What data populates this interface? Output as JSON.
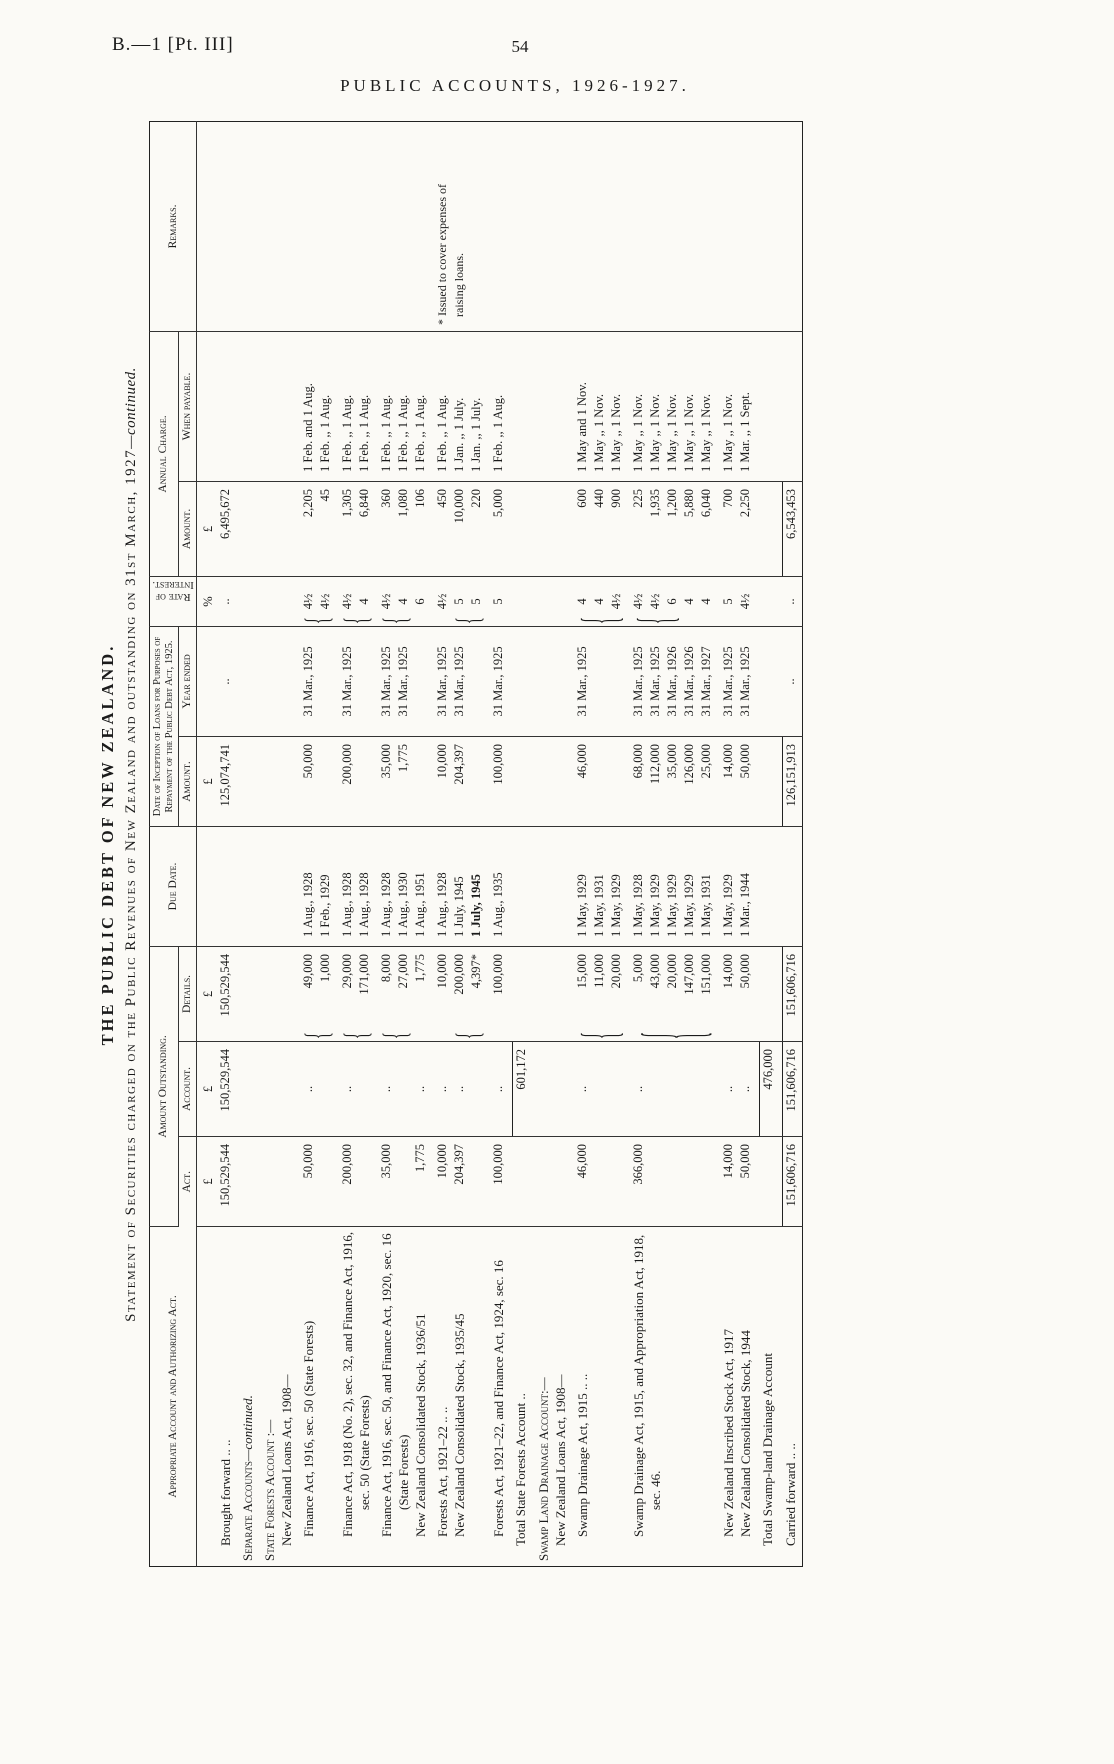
{
  "page": {
    "doc_ref": "B.—1 [Pt. III]",
    "page_number": "54",
    "running_title": "PUBLIC ACCOUNTS, 1926-1927."
  },
  "titles": {
    "main": "THE PUBLIC DEBT OF NEW ZEALAND.",
    "subtitle": "Statement of Securities charged on the Public Revenues of New Zealand and outstanding on 31st March, 1927",
    "subtitle_continued": "—continued."
  },
  "table": {
    "headers": {
      "account": "Appropriate Account and Authorizing Act.",
      "amount_outstanding": "Amount Outstanding.",
      "act": "Act.",
      "acct": "Account.",
      "details": "Details.",
      "due": "Due Date.",
      "inception": "Date of Inception of Loans for Purposes of Repayment of the Public Debt Act, 1925.",
      "incep_amount": "Amount.",
      "year": "Year ended",
      "rate": "Rate of Interest.",
      "annual": "Annual Charge.",
      "annual_amount": "Amount.",
      "payable": "When payable.",
      "remarks": "Remarks."
    },
    "rows": [
      {
        "name": "row-brought-forward",
        "label": [
          "",
          {
            "t": "Brought forward  ..  ..",
            "ind": 1
          }
        ],
        "cells": {
          "act": {
            "lines": [
              {
                "t": "£",
                "c": true
              },
              "150,529,544"
            ]
          },
          "acct": {
            "lines": [
              {
                "t": "£",
                "c": true
              },
              "150,529,544"
            ]
          },
          "details": {
            "lines": [
              {
                "t": "£",
                "c": true
              },
              "150,529,544"
            ]
          },
          "incep_amount": {
            "lines": [
              {
                "t": "£",
                "c": true
              },
              "125,074,741"
            ]
          },
          "year": {
            "lines": [
              "",
              {
                "t": "..",
                "c": true
              }
            ]
          },
          "rate": {
            "lines": [
              {
                "t": "%",
                "c": true
              },
              {
                "t": "..",
                "c": true
              }
            ]
          },
          "annual": {
            "lines": [
              {
                "t": "£",
                "c": true
              },
              "6,495,672"
            ]
          }
        }
      },
      {
        "name": "row-separate-accounts-heading",
        "label": [
          {
            "t": "Separate Accounts",
            "cls": "sc",
            "t2": "—continued.",
            "ind": 0
          }
        ]
      },
      {
        "name": "row-state-forests-heading",
        "label": [
          {
            "t": "State Forests Account :—",
            "cls": "sc",
            "ind": 0
          },
          {
            "t": "New Zealand Loans Act, 1908—",
            "ind": 1
          }
        ]
      },
      {
        "name": "row-finance-act-1916",
        "label": [
          {
            "t": "Finance Act, 1916, sec. 50 (State Forests)",
            "ind": 2
          }
        ],
        "cells": {
          "act": {
            "lines": [
              "50,000"
            ]
          },
          "acct": {
            "lines": [
              {
                "t": "..",
                "c": true
              }
            ]
          },
          "details": {
            "lines": [
              "49,000",
              "1,000"
            ],
            "brace": [
              0,
              1
            ]
          },
          "due": {
            "lines": [
              "1 Aug., 1928",
              "1 Feb., 1929"
            ]
          },
          "incep_amount": {
            "lines": [
              "50,000"
            ]
          },
          "year": {
            "lines": [
              "31 Mar., 1925"
            ]
          },
          "rate": {
            "lines": [
              "4½",
              "4½"
            ],
            "brace": [
              0,
              1
            ]
          },
          "annual": {
            "lines": [
              "2,205",
              "45"
            ]
          },
          "payable": {
            "lines": [
              "1 Feb. and 1 Aug.",
              "1 Feb.  ,,  1 Aug."
            ]
          }
        }
      },
      {
        "name": "row-finance-act-1918",
        "label": [
          {
            "t": "Finance Act, 1918 (No. 2), sec. 32, and Finance Act, 1916, sec. 50 (State Forests)",
            "ind": 2
          }
        ],
        "cells": {
          "act": {
            "lines": [
              "200,000"
            ]
          },
          "acct": {
            "lines": [
              {
                "t": "..",
                "c": true
              }
            ]
          },
          "details": {
            "lines": [
              "29,000",
              "171,000"
            ],
            "brace": [
              0,
              1
            ]
          },
          "due": {
            "lines": [
              "1 Aug., 1928",
              "1 Aug., 1928"
            ]
          },
          "incep_amount": {
            "lines": [
              "200,000"
            ]
          },
          "year": {
            "lines": [
              "31 Mar., 1925"
            ]
          },
          "rate": {
            "lines": [
              "4½",
              "4"
            ],
            "brace": [
              0,
              1
            ]
          },
          "annual": {
            "lines": [
              "1,305",
              "6,840"
            ]
          },
          "payable": {
            "lines": [
              "1 Feb.  ,,  1 Aug.",
              "1 Feb.  ,,  1 Aug."
            ]
          }
        }
      },
      {
        "name": "row-finance-act-1916-1920",
        "label": [
          {
            "t": "Finance Act, 1916, sec. 50, and Finance Act, 1920, sec. 16 (State Forests)",
            "ind": 2
          },
          {
            "t": "New Zealand Consolidated Stock, 1936/51",
            "ind": 2
          }
        ],
        "cells": {
          "act": {
            "lines": [
              "35,000",
              "",
              "1,775"
            ]
          },
          "acct": {
            "lines": [
              {
                "t": "..",
                "c": true
              },
              "",
              {
                "t": "..",
                "c": true
              }
            ]
          },
          "details": {
            "lines": [
              "8,000",
              "27,000",
              "1,775"
            ],
            "brace": [
              0,
              1
            ]
          },
          "due": {
            "lines": [
              "1 Aug., 1928",
              "1 Aug., 1930",
              "1 Aug., 1951"
            ]
          },
          "incep_amount": {
            "lines": [
              "35,000",
              "1,775"
            ]
          },
          "year": {
            "lines": [
              "31 Mar., 1925",
              "31 Mar., 1925"
            ]
          },
          "rate": {
            "lines": [
              "4½",
              "4",
              "6"
            ],
            "brace": [
              0,
              1
            ]
          },
          "annual": {
            "lines": [
              "360",
              "1,080",
              "106"
            ]
          },
          "payable": {
            "lines": [
              "1 Feb.  ,,  1 Aug.",
              "1 Feb.  ,,  1 Aug.",
              "1 Feb.  ,,  1 Aug."
            ]
          }
        }
      },
      {
        "name": "row-forests-act-1921-22",
        "label": [
          {
            "t": "Forests Act, 1921–22  ..  ..",
            "ind": 2
          },
          {
            "t": "New Zealand Consolidated Stock, 1935/45",
            "ind": 2
          }
        ],
        "cells": {
          "act": {
            "lines": [
              "10,000",
              "204,397"
            ]
          },
          "acct": {
            "lines": [
              {
                "t": "..",
                "c": true
              },
              {
                "t": "..",
                "c": true
              }
            ]
          },
          "details": {
            "lines": [
              "10,000",
              "200,000",
              "4,397*"
            ],
            "brace": [
              1,
              2
            ]
          },
          "due": {
            "lines": [
              "1 Aug., 1928",
              "1 July, 1945",
              {
                "t": "1 July, 1945",
                "b": true
              }
            ]
          },
          "incep_amount": {
            "lines": [
              "10,000",
              "204,397"
            ]
          },
          "year": {
            "lines": [
              "31 Mar., 1925",
              "31 Mar., 1925"
            ]
          },
          "rate": {
            "lines": [
              "4½",
              "5",
              "5"
            ],
            "brace": [
              1,
              2
            ]
          },
          "annual": {
            "lines": [
              "450",
              "10,000",
              "220"
            ]
          },
          "payable": {
            "lines": [
              "1 Feb.  ,,  1 Aug.",
              "1 Jan.  ,,  1 July.",
              "1 Jan.  ,,  1 July."
            ]
          },
          "remarks": {
            "lines": [
              "* Issued to cover expenses of",
              {
                "t": "raising loans.",
                "ind": 14
              }
            ]
          }
        }
      },
      {
        "name": "row-forests-act-1921-22-finance-1924",
        "label": [
          {
            "t": "Forests Act, 1921–22, and Finance Act, 1924, sec. 16",
            "ind": 2
          }
        ],
        "cells": {
          "act": {
            "lines": [
              "100,000"
            ]
          },
          "acct": {
            "lines": [
              {
                "t": "..",
                "c": true
              }
            ]
          },
          "details": {
            "lines": [
              "100,000"
            ]
          },
          "due": {
            "lines": [
              "1 Aug., 1935"
            ]
          },
          "incep_amount": {
            "lines": [
              "100,000"
            ]
          },
          "year": {
            "lines": [
              "31 Mar., 1925"
            ]
          },
          "rate": {
            "lines": [
              "5"
            ]
          },
          "annual": {
            "lines": [
              "5,000"
            ]
          },
          "payable": {
            "lines": [
              "1 Feb.  ,,  1 Aug."
            ]
          }
        }
      },
      {
        "name": "row-total-state-forests",
        "label": [
          {
            "t": "Total State Forests Account  ..",
            "ind": 1
          }
        ],
        "cells": {
          "acct": {
            "lines": [
              {
                "t": "601,172",
                "rule": true
              }
            ]
          }
        }
      },
      {
        "name": "row-swamp-land-heading",
        "label": [
          {
            "t": "Swamp Land Drainage Account:—",
            "cls": "sc",
            "ind": 0
          },
          {
            "t": "New Zealand Loans Act, 1908—",
            "ind": 1
          }
        ]
      },
      {
        "name": "row-swamp-drainage-1915",
        "label": [
          {
            "t": "Swamp Drainage Act, 1915  ..  ..",
            "ind": 2
          }
        ],
        "cells": {
          "act": {
            "lines": [
              "46,000"
            ]
          },
          "acct": {
            "lines": [
              {
                "t": "..",
                "c": true
              }
            ]
          },
          "details": {
            "lines": [
              "15,000",
              "11,000",
              "20,000"
            ],
            "brace": [
              0,
              2
            ]
          },
          "due": {
            "lines": [
              "1 May, 1929",
              "1 May, 1931",
              "1 May, 1929"
            ]
          },
          "incep_amount": {
            "lines": [
              "46,000"
            ]
          },
          "year": {
            "lines": [
              "31 Mar., 1925"
            ]
          },
          "rate": {
            "lines": [
              "4",
              "4",
              "4½"
            ],
            "brace": [
              0,
              2
            ]
          },
          "annual": {
            "lines": [
              "600",
              "440",
              "900"
            ]
          },
          "payable": {
            "lines": [
              "1 May and 1 Nov.",
              "1 May  ,,  1 Nov.",
              "1 May  ,,  1 Nov."
            ]
          }
        }
      },
      {
        "name": "row-swamp-drainage-1915-appropriation",
        "label": [
          {
            "t": "Swamp Drainage Act, 1915, and Appropriation Act, 1918, sec. 46.",
            "ind": 2
          }
        ],
        "cells": {
          "act": {
            "lines": [
              "366,000"
            ]
          },
          "acct": {
            "lines": [
              {
                "t": "..",
                "c": true
              }
            ]
          },
          "details": {
            "lines": [
              "5,000",
              "43,000",
              "20,000",
              "147,000",
              "151,000"
            ],
            "brace": [
              0,
              4
            ]
          },
          "due": {
            "lines": [
              "1 May, 1928",
              "1 May, 1929",
              "1 May, 1929",
              "1 May, 1929",
              "1 May, 1931"
            ]
          },
          "incep_amount": {
            "lines": [
              "68,000",
              "112,000",
              "35,000",
              "126,000",
              "25,000"
            ]
          },
          "year": {
            "lines": [
              "31 Mar., 1925",
              "31 Mar., 1925",
              "31 Mar., 1926",
              "31 Mar., 1926",
              "31 Mar., 1927"
            ]
          },
          "rate": {
            "lines": [
              "4½",
              "4½",
              "6",
              "4",
              "4"
            ],
            "brace": [
              0,
              2
            ]
          },
          "annual": {
            "lines": [
              "225",
              "1,935",
              "1,200",
              "5,880",
              "6,040"
            ]
          },
          "payable": {
            "lines": [
              "1 May  ,,  1 Nov.",
              "1 May  ,,  1 Nov.",
              "1 May  ,,  1 Nov.",
              "1 May  ,,  1 Nov.",
              "1 May  ,,  1 Nov."
            ]
          }
        }
      },
      {
        "name": "row-nz-inscribed-stock-1917",
        "label": [
          {
            "t": "New Zealand Inscribed Stock Act, 1917",
            "ind": 2
          },
          {
            "t": "New Zealand Consolidated Stock, 1944",
            "ind": 2
          }
        ],
        "cells": {
          "act": {
            "lines": [
              "14,000",
              "50,000"
            ]
          },
          "acct": {
            "lines": [
              {
                "t": "..",
                "c": true
              },
              {
                "t": "..",
                "c": true
              }
            ]
          },
          "details": {
            "lines": [
              "14,000",
              "50,000"
            ]
          },
          "due": {
            "lines": [
              "1 May, 1929",
              "1 Mar., 1944"
            ]
          },
          "incep_amount": {
            "lines": [
              "14,000",
              "50,000"
            ]
          },
          "year": {
            "lines": [
              "31 Mar., 1925",
              "31 Mar., 1925"
            ]
          },
          "rate": {
            "lines": [
              "5",
              "4½"
            ]
          },
          "annual": {
            "lines": [
              "700",
              "2,250"
            ]
          },
          "payable": {
            "lines": [
              "1 May  ,,  1 Nov.",
              "1 Mar.  ,,  1 Sept."
            ]
          }
        }
      },
      {
        "name": "row-total-swamp-land",
        "label": [
          {
            "t": "Total Swamp-land Drainage Account",
            "ind": 1
          }
        ],
        "cells": {
          "acct": {
            "lines": [
              {
                "t": "476,000",
                "rule": true
              }
            ]
          }
        }
      },
      {
        "name": "row-carried-forward",
        "label": [
          {
            "t": "Carried forward  ..  ..",
            "ind": 1
          }
        ],
        "cells": {
          "act": {
            "lines": [
              {
                "t": "151,606,716",
                "rule": true
              }
            ]
          },
          "acct": {
            "lines": [
              {
                "t": "151,606,716",
                "rule": true
              }
            ]
          },
          "details": {
            "lines": [
              {
                "t": "151,606,716",
                "rule": true
              }
            ]
          },
          "incep_amount": {
            "lines": [
              {
                "t": "126,151,913",
                "rule": true
              }
            ]
          },
          "year": {
            "lines": [
              {
                "t": "..",
                "c": true
              }
            ]
          },
          "rate": {
            "lines": [
              {
                "t": "..",
                "c": true
              }
            ]
          },
          "annual": {
            "lines": [
              {
                "t": "6,543,453",
                "rule": true
              }
            ]
          }
        }
      }
    ]
  }
}
